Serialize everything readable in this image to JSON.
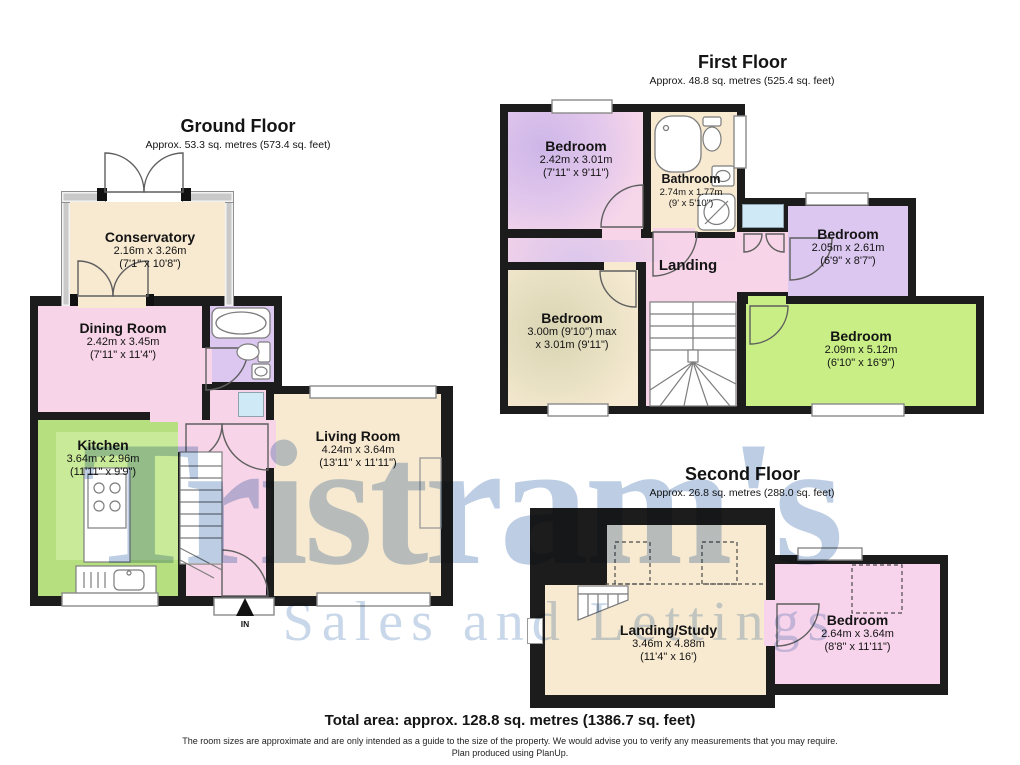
{
  "floors": [
    {
      "title": "Ground Floor",
      "subtitle": "Approx. 53.3 sq. metres (573.4 sq. feet)",
      "entrance_label": "IN",
      "rooms": [
        {
          "label": "Conservatory",
          "dim_m": "2.16m x 3.26m",
          "dim_ft": "(7'1\" x 10'8\")"
        },
        {
          "label": "Dining Room",
          "dim_m": "2.42m x 3.45m",
          "dim_ft": "(7'11\" x 11'4\")"
        },
        {
          "label": "Kitchen",
          "dim_m": "3.64m x 2.96m",
          "dim_ft": "(11'11\" x 9'9\")"
        },
        {
          "label": "Living Room",
          "dim_m": "4.24m x 3.64m",
          "dim_ft": "(13'11\" x 11'11\")"
        }
      ]
    },
    {
      "title": "First Floor",
      "subtitle": "Approx. 48.8 sq. metres (525.4 sq. feet)",
      "rooms": [
        {
          "label": "Bedroom",
          "dim_m": "2.42m x 3.01m",
          "dim_ft": "(7'11\" x 9'11\")"
        },
        {
          "label": "Bathroom",
          "dim_m": "2.74m x 1.77m",
          "dim_ft": "(9' x 5'10\")"
        },
        {
          "label": "Landing"
        },
        {
          "label": "Bedroom",
          "dim_m": "3.00m (9'10\") max",
          "dim_ft": "x 3.01m (9'11\")"
        },
        {
          "label": "Bedroom",
          "dim_m": "2.05m x 2.61m",
          "dim_ft": "(6'9\" x 8'7\")"
        },
        {
          "label": "Bedroom",
          "dim_m": "2.09m x 5.12m",
          "dim_ft": "(6'10\" x 16'9\")"
        }
      ]
    },
    {
      "title": "Second Floor",
      "subtitle": "Approx. 26.8 sq. metres (288.0 sq. feet)",
      "rooms": [
        {
          "label": "Landing/Study",
          "dim_m": "3.46m x 4.88m",
          "dim_ft": "(11'4\" x 16')"
        },
        {
          "label": "Bedroom",
          "dim_m": "2.64m x 3.64m",
          "dim_ft": "(8'8\" x 11'11\")"
        }
      ]
    }
  ],
  "watermark": {
    "line1": "Tristram's",
    "line2": "Sales and Lettings"
  },
  "footer": {
    "total_area": "Total area: approx. 128.8 sq. metres (1386.7 sq. feet)",
    "disclaimer": "The room sizes are approximate and are only intended as a guide to the size of the property. We would advise you to verify any measurements that you may require.",
    "produced_by": "Plan produced using PlanUp."
  },
  "colors": {
    "wall": "#1c1c1c",
    "cream": "#f8ead1",
    "pink": "#f7d4e7",
    "purple": "#dcc7f1",
    "kitchen_green": "#b6e07f",
    "bedroom_green": "#c8ee85",
    "light_blue": "#cfeaf6",
    "watermark_blue": "#6a90c2"
  }
}
